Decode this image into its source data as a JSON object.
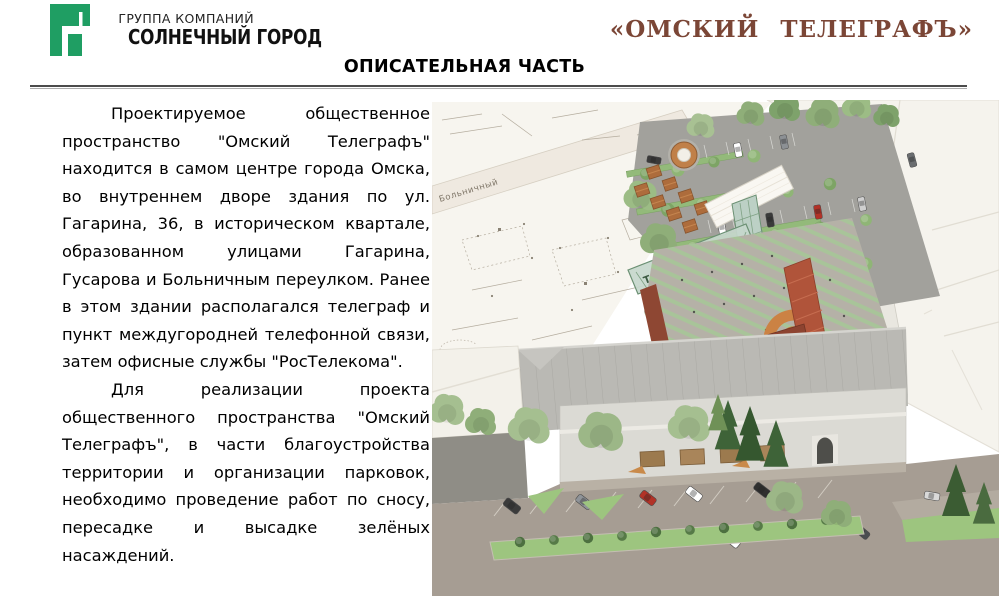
{
  "branding": {
    "group_label": "ГРУППА КОМПАНИЙ",
    "company_name": "СОЛНЕЧНЫЙ ГОРОД",
    "logo_green": "#1f9e63"
  },
  "header": {
    "project_title": "«ОМСКИЙ ТЕЛЕГРАФЪ»",
    "project_title_color": "#7b4636",
    "section_title": "ОПИСАТЕЛЬНАЯ ЧАСТЬ"
  },
  "body": {
    "paragraphs": [
      "Проектируемое общественное пространство \"Омский Телеграфъ\" находится в самом центре города Омска, во внутреннем дворе здания по ул. Гагарина, 36, в историческом квартале, образованном улицами Гагарина, Гусарова и Больничным переулком. Ранее в этом здании располагался телеграф и пункт междугородней телефонной связи, затем офисные службы \"РосТелекома\".",
      "Для реализации проекта общественного пространства \"Омский Телеграфъ\", в части благоустройства территории и организации парковок, необходимо проведение работ по сносу, пересадке и высадке зелёных насаждений."
    ]
  },
  "illustration": {
    "kind": "3d-aerial-architectural-render",
    "map_street_label": "Больничный",
    "bridge_label": "ТЕЛЕГРАФЪ",
    "palette": {
      "map_paper": "#f7f5ef",
      "asphalt": "#a2a19c",
      "street": "#a69d93",
      "tree_light": "#a5bf90",
      "tree_dark": "#3e6338",
      "lawn": "#9dc57f",
      "facade": "#dbdad4",
      "roof": "#bab9b4",
      "brick": "#8e4733",
      "terracotta": "#cc8245",
      "glass": "#c6d7cc",
      "white_massing": "#f5f3ed"
    }
  }
}
